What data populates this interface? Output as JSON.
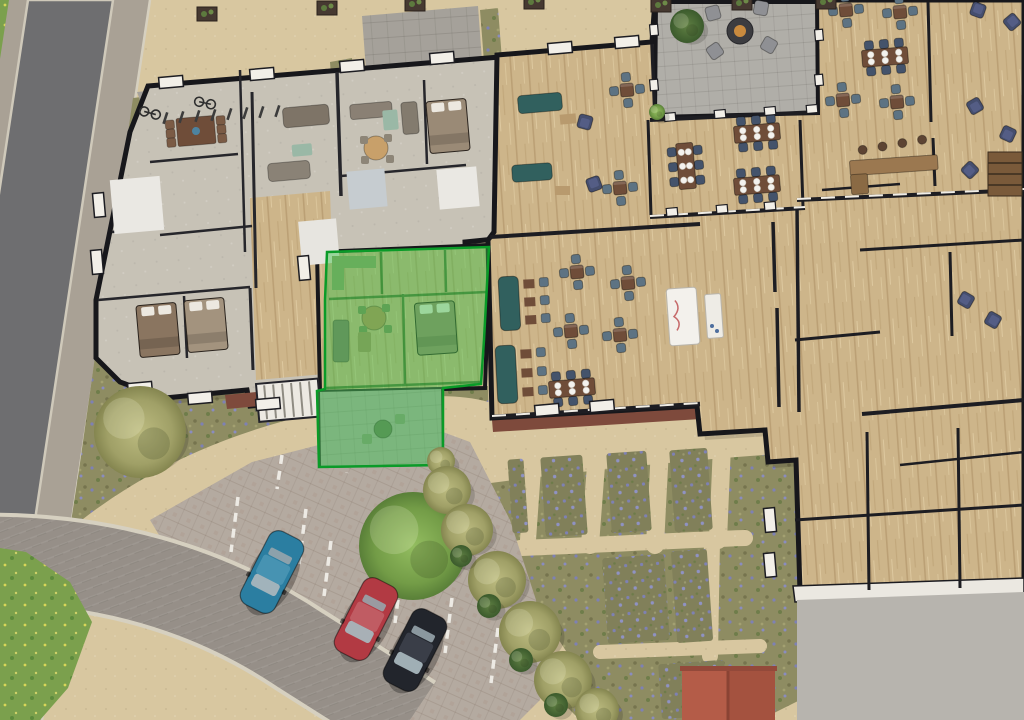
{
  "meta": {
    "title": "aerial-site-plan",
    "type": "3d-architectural-floor-plan-render",
    "highlighted_unit": {
      "name": "highlighted-apartment",
      "rooms": [
        "kitchen",
        "bathroom",
        "living-room",
        "bedroom",
        "patio"
      ],
      "selected": true
    },
    "counts": {
      "parked_cars": 3,
      "garden_beds": 7,
      "bike_racks": 8,
      "bicycles": 2
    }
  },
  "colors": {
    "sand_path": "#d8c7a0",
    "olive_grass": "#8e8c62",
    "grass_green": "#7ba04d",
    "lavender": "#7e81b4",
    "road_asphalt": "#6e6e70",
    "sidewalk": "#a9a195",
    "paving": "#a5a19a",
    "patio_paving": "#b0aea8",
    "bays_paving": "#b4aaa0",
    "drive_paving": "#968f88",
    "wood_floor": "#cdb58a",
    "gray_floor": "#c7c2b6",
    "wall_black": "#17171b",
    "wall_white": "#f2efe8",
    "highlight_fill": "#3cc24a",
    "highlight_stroke": "#0a9b28",
    "teal_sofa": "#31605e",
    "navy_chair": "#454e6e",
    "chair_bluegray": "#5d7383",
    "table_brown": "#6f4d39",
    "car_blue": "#2b7ea1",
    "car_blue_roof": "#4793b2",
    "car_red": "#b23a43",
    "car_red_roof": "#c05c63",
    "car_black": "#22252c",
    "car_black_roof": "#3a3e48",
    "shed_roof": "#b45c48",
    "terrace": "#b7b4ae",
    "fire_pit": "#3c3c40",
    "tree_olive": "#a9a873",
    "tree_green": "#7fa551"
  },
  "cars": [
    {
      "id": "car-blue",
      "body": "car_blue",
      "roof": "car_blue_roof",
      "x": 272,
      "y": 572,
      "r": 27
    },
    {
      "id": "car-red",
      "body": "car_red",
      "roof": "car_red_roof",
      "x": 366,
      "y": 619,
      "r": 27
    },
    {
      "id": "car-black",
      "body": "car_black",
      "roof": "car_black_roof",
      "x": 415,
      "y": 650,
      "r": 27
    }
  ],
  "dining_sets_4": [
    {
      "x": 577,
      "y": 272,
      "r": -5
    },
    {
      "x": 628,
      "y": 283,
      "r": -5
    },
    {
      "x": 571,
      "y": 331,
      "r": -5
    },
    {
      "x": 620,
      "y": 335,
      "r": -5
    },
    {
      "x": 627,
      "y": 90,
      "r": -5
    },
    {
      "x": 620,
      "y": 188,
      "r": -5
    },
    {
      "x": 846,
      "y": 10,
      "r": -5
    },
    {
      "x": 900,
      "y": 12,
      "r": -5
    },
    {
      "x": 843,
      "y": 100,
      "r": -5
    },
    {
      "x": 897,
      "y": 102,
      "r": -5
    }
  ],
  "long_tables": [
    {
      "x": 686,
      "y": 166,
      "r": -5,
      "vert": true
    },
    {
      "x": 757,
      "y": 133,
      "r": 85,
      "vert": false
    },
    {
      "x": 757,
      "y": 185,
      "r": 85,
      "vert": false
    },
    {
      "x": 572,
      "y": 388,
      "r": 85,
      "vert": false
    },
    {
      "x": 885,
      "y": 57,
      "r": 85,
      "vert": false
    }
  ],
  "armchairs": [
    {
      "x": 585,
      "y": 122,
      "r": 15
    },
    {
      "x": 594,
      "y": 184,
      "r": 160
    },
    {
      "x": 978,
      "y": 10,
      "r": 200
    },
    {
      "x": 1012,
      "y": 22,
      "r": 230
    },
    {
      "x": 975,
      "y": 106,
      "r": -30
    },
    {
      "x": 1008,
      "y": 134,
      "r": 25
    },
    {
      "x": 966,
      "y": 300,
      "r": 120
    },
    {
      "x": 993,
      "y": 320,
      "r": 300
    },
    {
      "x": 970,
      "y": 170,
      "r": 45
    }
  ],
  "beds": [
    {
      "x": 448,
      "y": 126,
      "r": -5,
      "c": "#9a8a76"
    },
    {
      "x": 158,
      "y": 330,
      "r": -5,
      "c": "#8a7560"
    },
    {
      "x": 206,
      "y": 325,
      "r": -5,
      "c": "#a3937e"
    },
    {
      "x": 436,
      "y": 328,
      "r": -4,
      "c": "#97876f"
    }
  ],
  "bay_windows": [
    {
      "x": 171,
      "y": 82,
      "r": -5
    },
    {
      "x": 262,
      "y": 74,
      "r": -5
    },
    {
      "x": 352,
      "y": 66,
      "r": -5
    },
    {
      "x": 442,
      "y": 58,
      "r": -5
    },
    {
      "x": 560,
      "y": 48,
      "r": -5
    },
    {
      "x": 627,
      "y": 42,
      "r": -5
    },
    {
      "x": 99,
      "y": 205,
      "r": 85
    },
    {
      "x": 97,
      "y": 262,
      "r": 85
    },
    {
      "x": 140,
      "y": 388,
      "r": -5
    },
    {
      "x": 200,
      "y": 398,
      "r": -5
    },
    {
      "x": 268,
      "y": 404,
      "r": -5
    },
    {
      "x": 304,
      "y": 268,
      "r": 85
    },
    {
      "x": 547,
      "y": 410,
      "r": -5
    },
    {
      "x": 602,
      "y": 406,
      "r": -5
    },
    {
      "x": 770,
      "y": 520,
      "r": 85
    },
    {
      "x": 770,
      "y": 565,
      "r": 85
    }
  ],
  "piers": [
    {
      "x": 670,
      "y": 117,
      "r": -5
    },
    {
      "x": 720,
      "y": 114,
      "r": -5
    },
    {
      "x": 770,
      "y": 111,
      "r": -5
    },
    {
      "x": 812,
      "y": 109,
      "r": -5
    },
    {
      "x": 819,
      "y": 35,
      "r": 85
    },
    {
      "x": 819,
      "y": 80,
      "r": 85
    },
    {
      "x": 654,
      "y": 30,
      "r": 85
    },
    {
      "x": 654,
      "y": 85,
      "r": 85
    },
    {
      "x": 672,
      "y": 212,
      "r": -5
    },
    {
      "x": 722,
      "y": 209,
      "r": -5
    },
    {
      "x": 770,
      "y": 206,
      "r": -5
    }
  ],
  "parking_lines": [
    {
      "x1": 238,
      "y1": 497,
      "x2": 231,
      "y2": 552
    },
    {
      "x1": 306,
      "y1": 509,
      "x2": 299,
      "y2": 564
    },
    {
      "x1": 331,
      "y1": 541,
      "x2": 324,
      "y2": 596
    },
    {
      "x1": 402,
      "y1": 568,
      "x2": 395,
      "y2": 623
    },
    {
      "x1": 452,
      "y1": 598,
      "x2": 445,
      "y2": 653
    },
    {
      "x1": 498,
      "y1": 628,
      "x2": 491,
      "y2": 683
    },
    {
      "x1": 282,
      "y1": 455,
      "x2": 277,
      "y2": 489
    },
    {
      "x1": 352,
      "y1": 441,
      "x2": 347,
      "y2": 473
    }
  ],
  "planters": [
    {
      "x": 207,
      "y": 14
    },
    {
      "x": 327,
      "y": 8
    },
    {
      "x": 415,
      "y": 4
    },
    {
      "x": 534,
      "y": 2
    },
    {
      "x": 661,
      "y": 5
    },
    {
      "x": 742,
      "y": 3
    },
    {
      "x": 826,
      "y": 2
    }
  ],
  "bike_racks": [
    {
      "x": 166,
      "y": 112
    },
    {
      "x": 182,
      "y": 111
    },
    {
      "x": 198,
      "y": 110
    },
    {
      "x": 214,
      "y": 109
    },
    {
      "x": 230,
      "y": 108
    },
    {
      "x": 246,
      "y": 107
    },
    {
      "x": 262,
      "y": 106
    },
    {
      "x": 278,
      "y": 105
    }
  ],
  "bicycles": [
    {
      "x": 150,
      "y": 113,
      "r": 15
    },
    {
      "x": 205,
      "y": 103,
      "r": 12
    }
  ],
  "garden_beds": [
    {
      "x": 543,
      "y": 456,
      "w": 42,
      "h": 80
    },
    {
      "x": 609,
      "y": 452,
      "w": 40,
      "h": 80
    },
    {
      "x": 672,
      "y": 449,
      "w": 38,
      "h": 82
    },
    {
      "x": 605,
      "y": 556,
      "w": 62,
      "h": 86
    },
    {
      "x": 674,
      "y": 550,
      "w": 36,
      "h": 92
    },
    {
      "x": 510,
      "y": 459,
      "w": 16,
      "h": 74
    },
    {
      "x": 660,
      "y": 662,
      "w": 66,
      "h": 55
    }
  ],
  "bushes": [
    {
      "x": 140,
      "y": 432,
      "r": 46,
      "v": "olive"
    },
    {
      "x": 413,
      "y": 546,
      "r": 54,
      "v": "green"
    },
    {
      "x": 441,
      "y": 461,
      "r": 14,
      "v": "olive"
    },
    {
      "x": 447,
      "y": 490,
      "r": 24,
      "v": "olive"
    },
    {
      "x": 467,
      "y": 530,
      "r": 26,
      "v": "olive"
    },
    {
      "x": 497,
      "y": 580,
      "r": 29,
      "v": "olive"
    },
    {
      "x": 530,
      "y": 632,
      "r": 31,
      "v": "olive"
    },
    {
      "x": 563,
      "y": 680,
      "r": 29,
      "v": "olive"
    },
    {
      "x": 597,
      "y": 710,
      "r": 22,
      "v": "olive"
    },
    {
      "x": 461,
      "y": 556,
      "r": 11,
      "v": "dark"
    },
    {
      "x": 489,
      "y": 606,
      "r": 12,
      "v": "dark"
    },
    {
      "x": 521,
      "y": 660,
      "r": 12,
      "v": "dark"
    },
    {
      "x": 556,
      "y": 705,
      "r": 12,
      "v": "dark"
    },
    {
      "x": 687,
      "y": 26,
      "r": 17,
      "v": "dark"
    },
    {
      "x": 657,
      "y": 112,
      "r": 8,
      "v": "green"
    }
  ]
}
